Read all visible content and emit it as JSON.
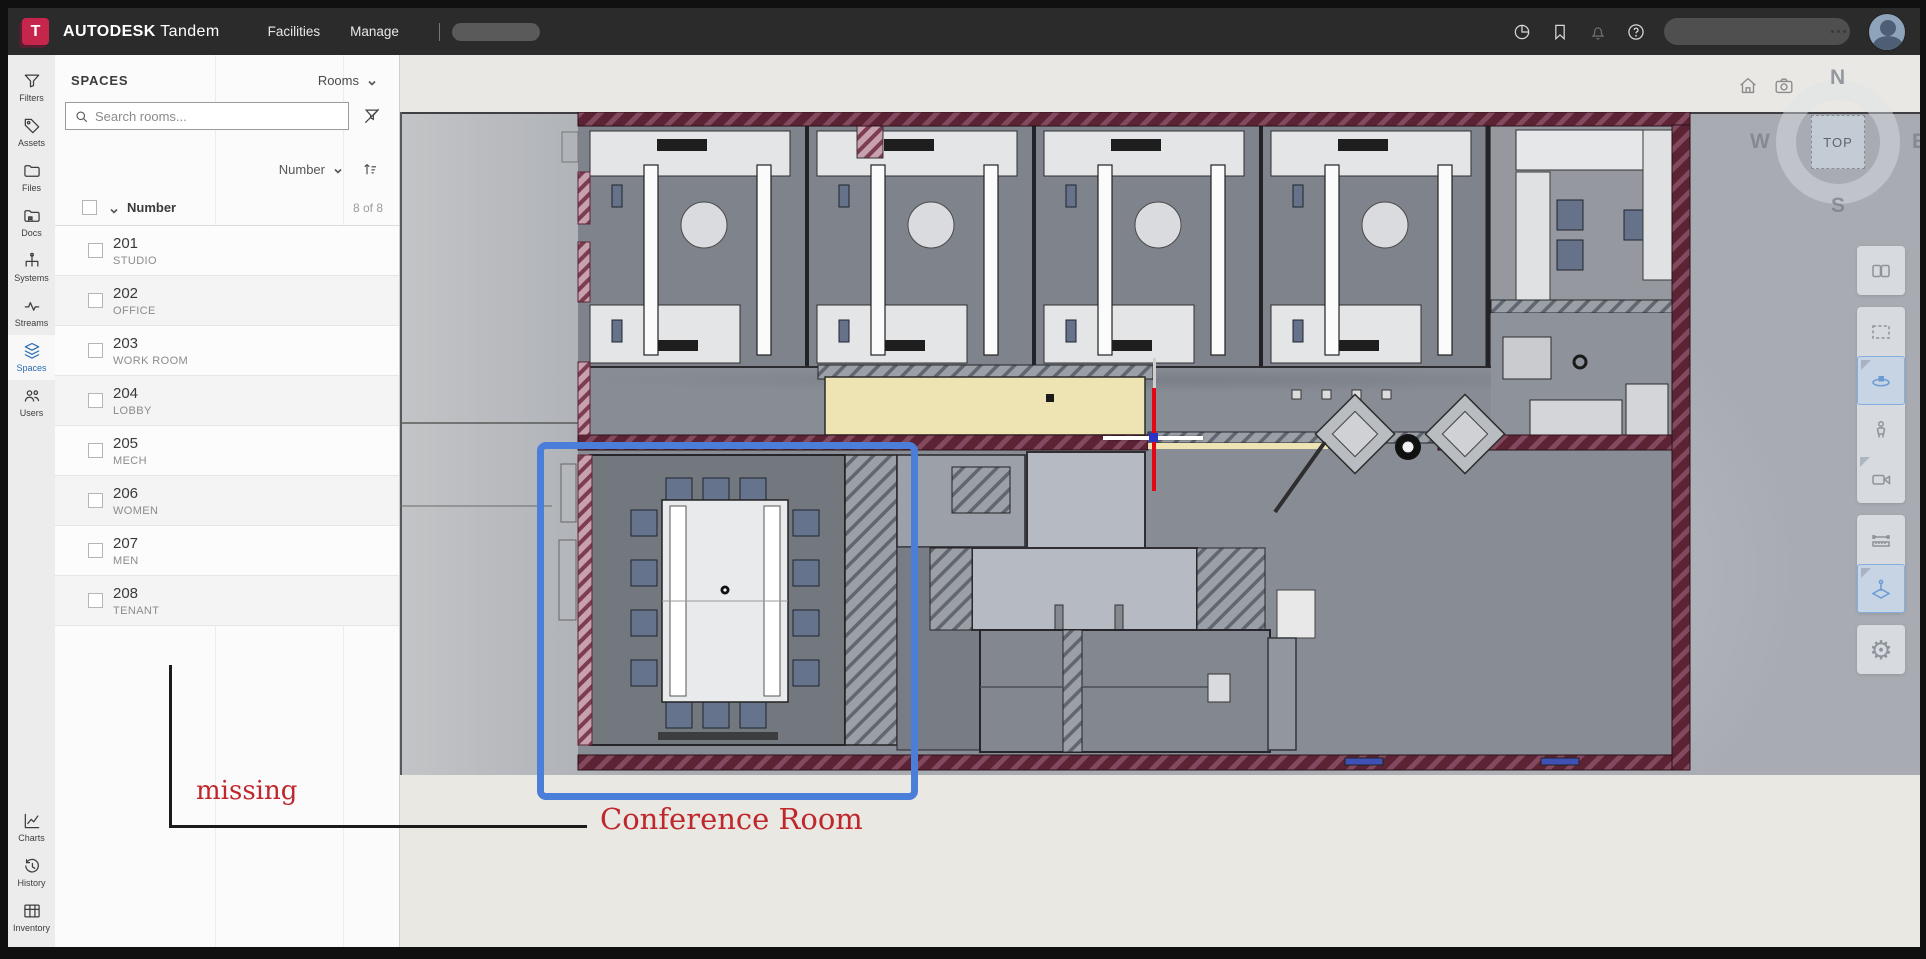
{
  "topbar": {
    "logo_letter": "T",
    "brand": "AUTODESK",
    "product": "Tandem",
    "nav": [
      {
        "label": "Facilities"
      },
      {
        "label": "Manage"
      }
    ],
    "icons": [
      "pie-usage-icon",
      "bookmark-icon",
      "bell-icon",
      "help-icon"
    ]
  },
  "sidebar": {
    "items": [
      {
        "label": "Filters",
        "icon": "funnel-icon"
      },
      {
        "label": "Assets",
        "icon": "tag-icon"
      },
      {
        "label": "Files",
        "icon": "folder-icon"
      },
      {
        "label": "Docs",
        "icon": "docs-folder-icon"
      },
      {
        "label": "Systems",
        "icon": "systems-tree-icon"
      },
      {
        "label": "Streams",
        "icon": "pulse-icon"
      },
      {
        "label": "Spaces",
        "icon": "layers-icon",
        "active": true
      },
      {
        "label": "Users",
        "icon": "people-icon"
      }
    ],
    "bottom_items": [
      {
        "label": "Charts",
        "icon": "line-chart-icon"
      },
      {
        "label": "History",
        "icon": "history-clock-icon"
      },
      {
        "label": "Inventory",
        "icon": "table-grid-icon"
      }
    ]
  },
  "panel": {
    "title": "SPACES",
    "type_selector": "Rooms",
    "search_placeholder": "Search rooms...",
    "sort_column": "Number",
    "list_header": {
      "column": "Number",
      "count": "8 of 8"
    },
    "rows": [
      {
        "number": "201",
        "name": "STUDIO"
      },
      {
        "number": "202",
        "name": "OFFICE"
      },
      {
        "number": "203",
        "name": "WORK ROOM"
      },
      {
        "number": "204",
        "name": "LOBBY"
      },
      {
        "number": "205",
        "name": "MECH"
      },
      {
        "number": "206",
        "name": "WOMEN"
      },
      {
        "number": "207",
        "name": "MEN"
      },
      {
        "number": "208",
        "name": "TENANT"
      }
    ]
  },
  "viewer": {
    "viewcube": {
      "top": "TOP",
      "north": "N",
      "south": "S",
      "east": "E",
      "west": "W"
    },
    "annotations": {
      "missing": "missing",
      "conference": "Conference Room"
    },
    "colors": {
      "annotation_red": "#bf272c",
      "annotation_blue": "#4a7ed9",
      "wall_maroon": "#5c2334",
      "room_yellow": "#eee4b3",
      "active_blue": "#2a6db3"
    }
  }
}
